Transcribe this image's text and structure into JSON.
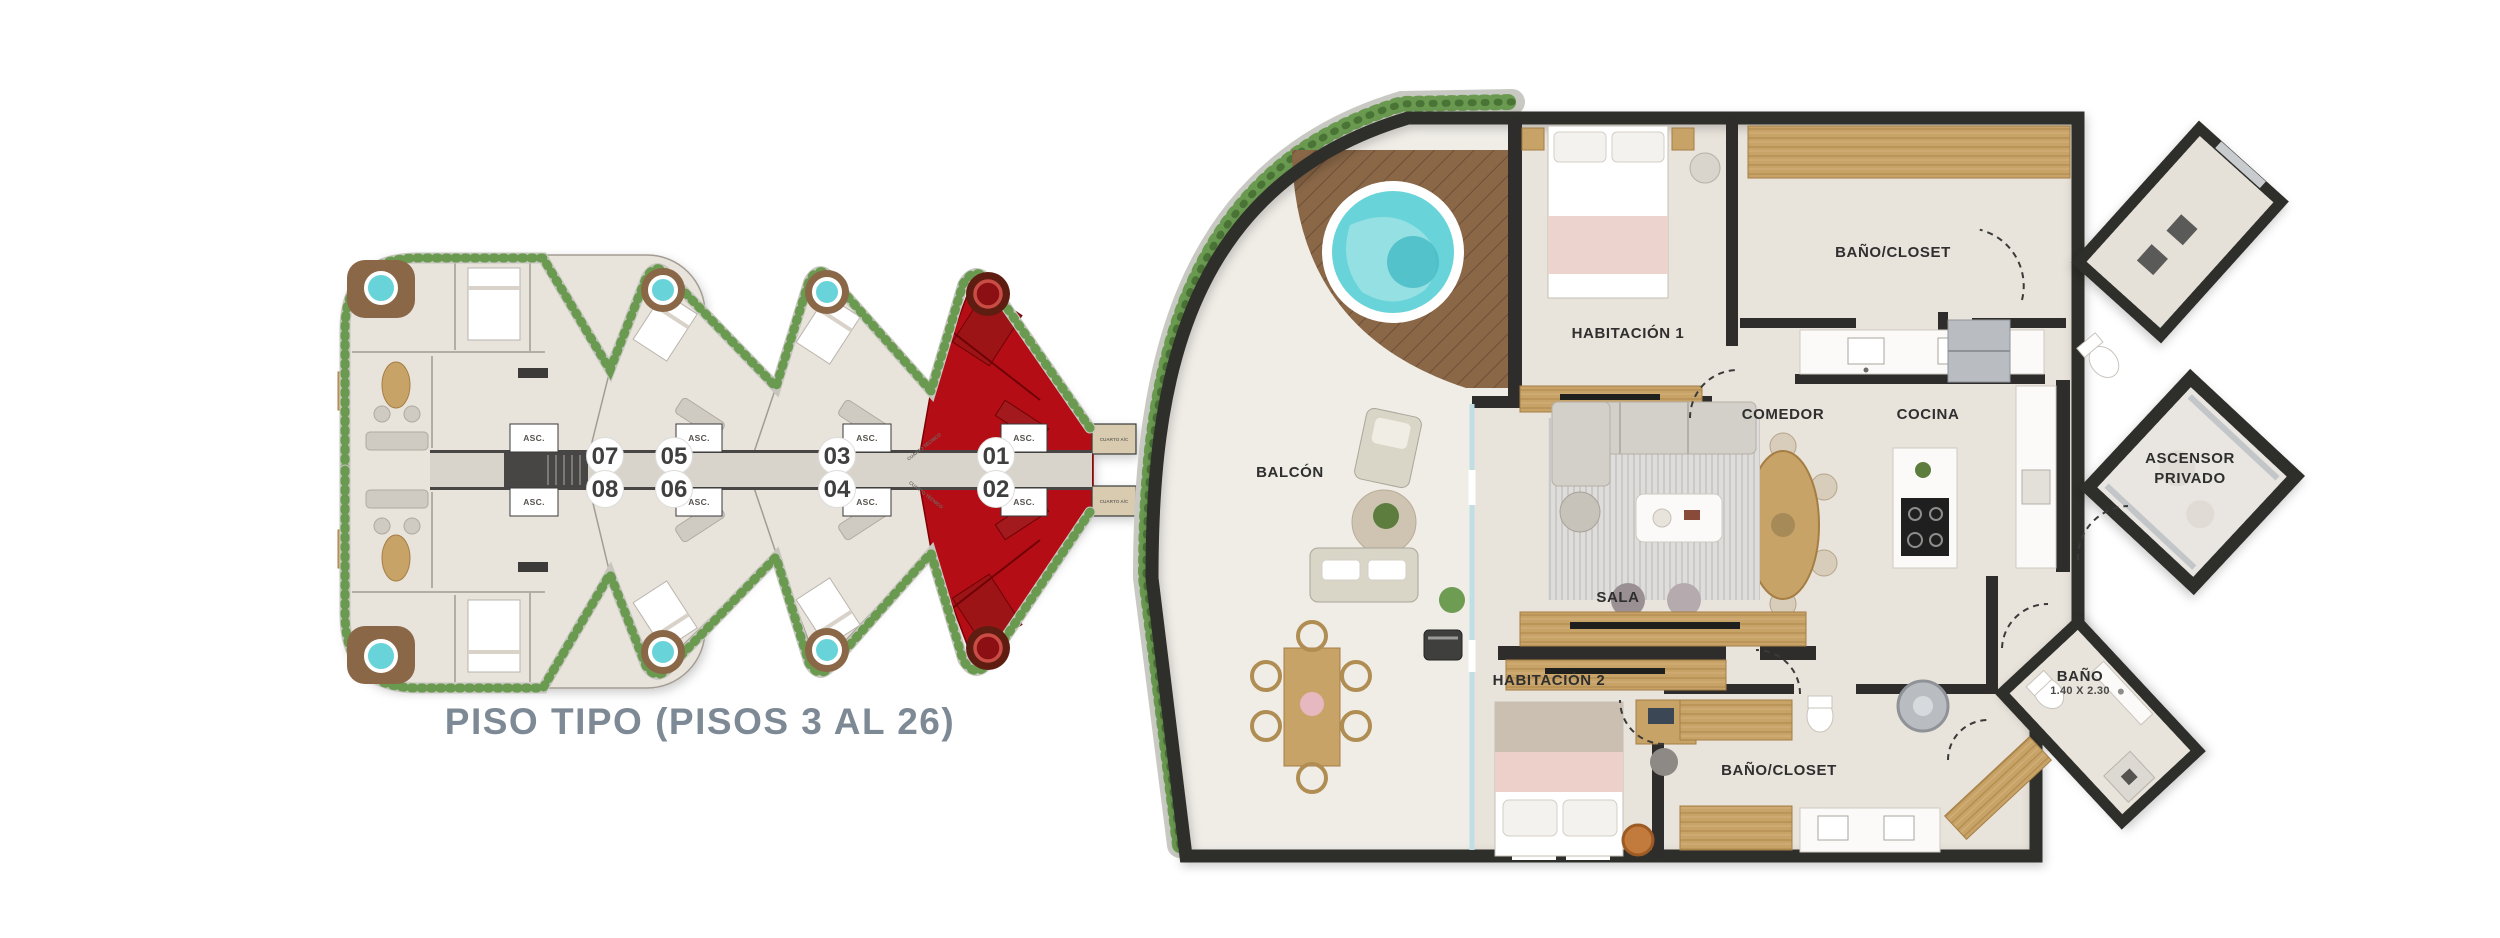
{
  "page": {
    "background": "#ffffff"
  },
  "overview": {
    "title": "PISO TIPO (PISOS 3 AL 26)",
    "units": [
      "07",
      "08",
      "05",
      "06",
      "03",
      "04",
      "01",
      "02"
    ],
    "highlighted_units": [
      "01",
      "02"
    ],
    "elevator_label": "ASC.",
    "technical_room_label": "CUARTO TÉCNICO",
    "ac_room_label": "CUARTO A/C",
    "colors": {
      "highlight": "#b50d12",
      "title": "#7d8994"
    }
  },
  "detail": {
    "rooms": {
      "balcon": "BALCÓN",
      "habitacion_1": "HABITACIÓN 1",
      "bano_closet_top": "BAÑO/CLOSET",
      "comedor": "COMEDOR",
      "cocina": "COCINA",
      "sala": "SALA",
      "habitacion_2": "HABITACIÓN 2",
      "bano_closet_bottom": "BAÑO/CLOSET",
      "ascensor_privado_line1": "ASCENSOR",
      "ascensor_privado_line2": "PRIVADO",
      "bano": "BAÑO",
      "bano_dimensions": "1.40 X 2.30"
    }
  },
  "colors": {
    "wall": "#2e2d2c",
    "floor": "#e8e3db",
    "corridor": "#d9d4cb",
    "wood": "#c8a368",
    "deck": "#8a6747",
    "hedge": "#6a9a50",
    "pool": "#68d4da",
    "highlight_red": "#b50d12"
  }
}
